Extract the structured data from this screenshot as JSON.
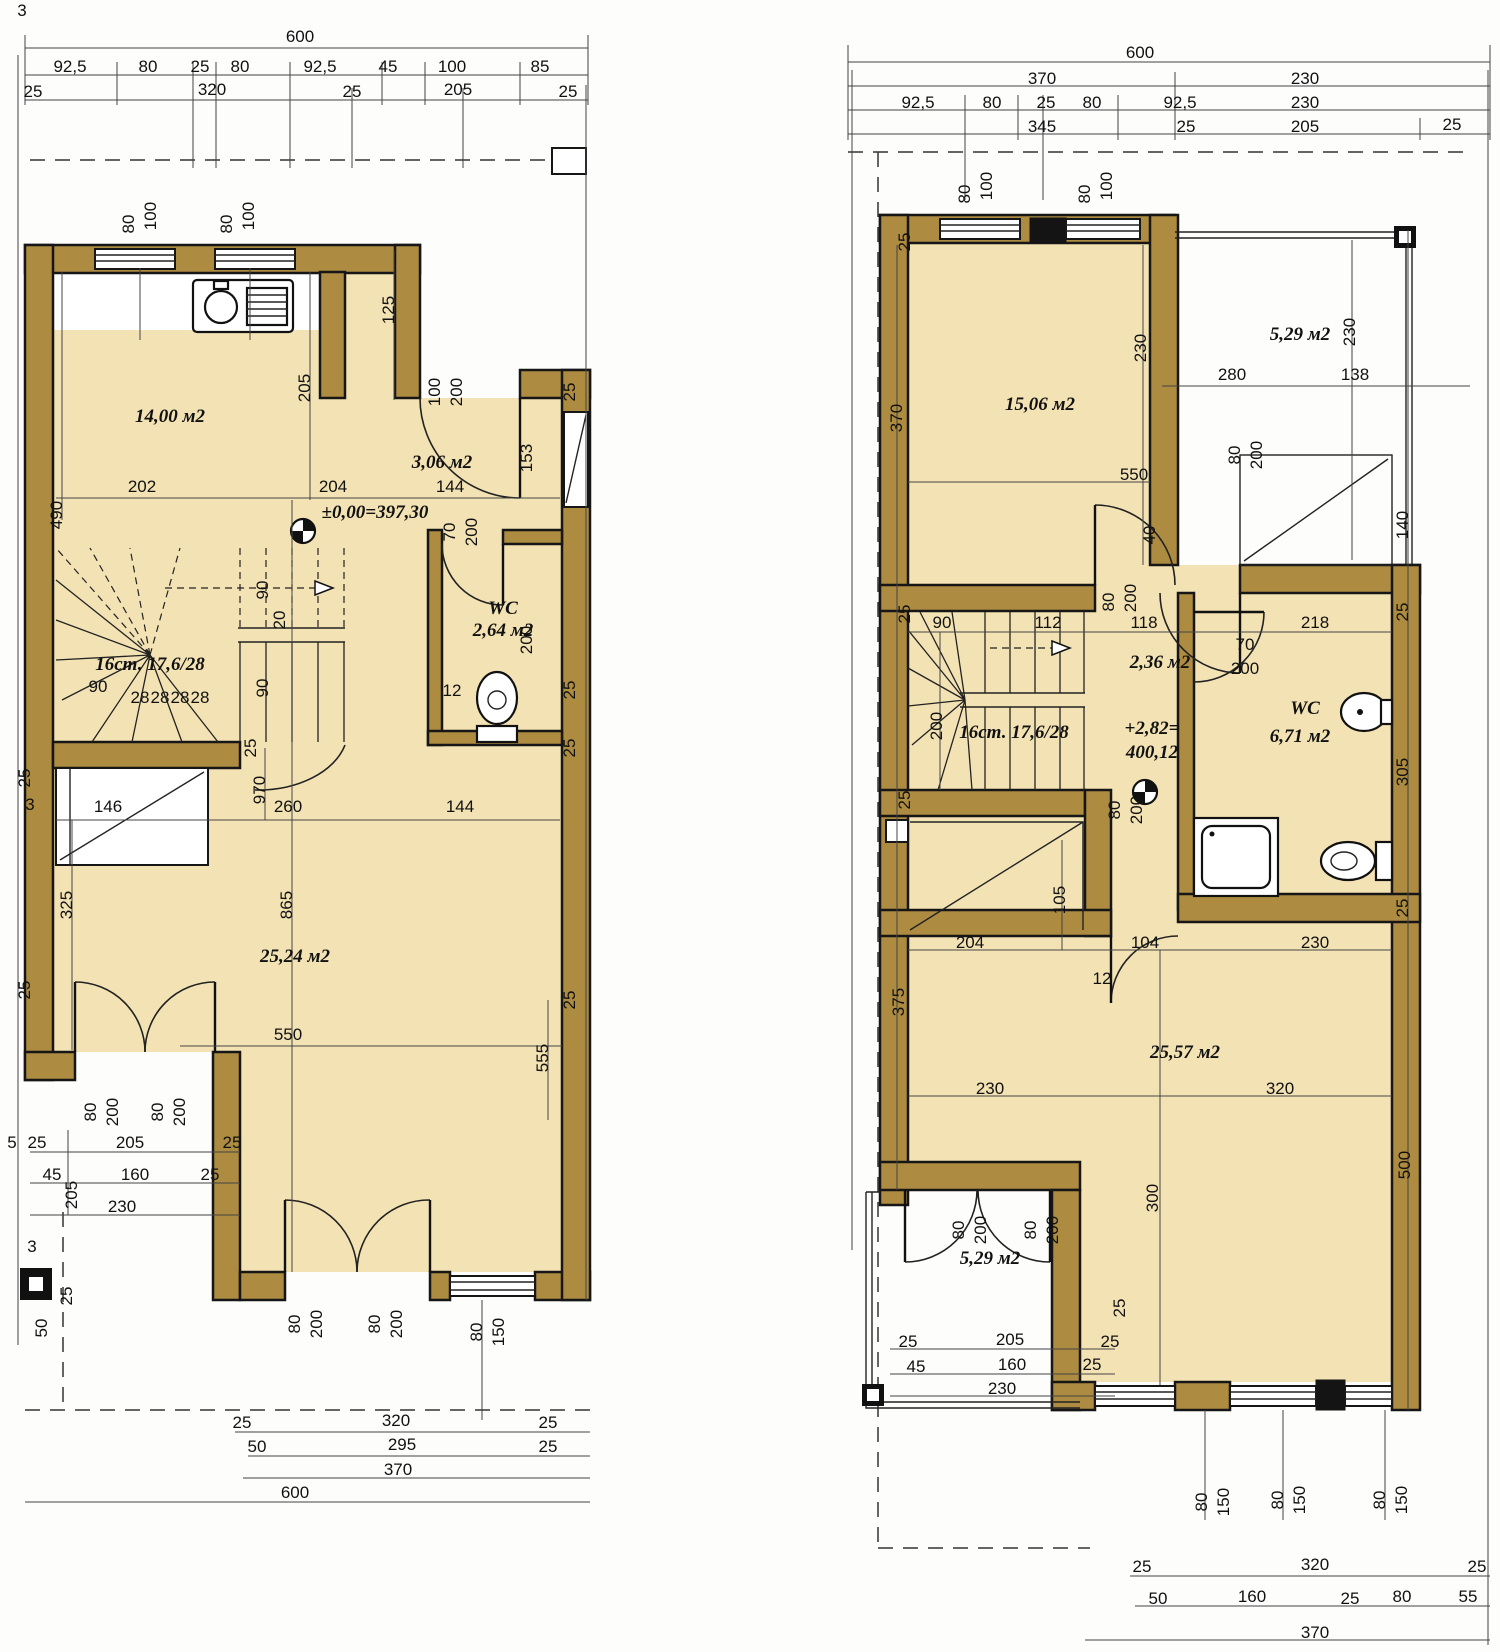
{
  "drawing": {
    "type": "architectural floor plans",
    "units": "cm",
    "plans": {
      "left": {
        "name": "ground floor plan",
        "overall_width": "600",
        "level_mark": "±0,00=397,30",
        "stairs": "16ст. 17,6/28",
        "rooms": [
          "14,00 м2",
          "3,06 м2",
          "WC 2,64 м2",
          "25,24 м2"
        ]
      },
      "right": {
        "name": "upper floor plan",
        "overall_width": "600",
        "level_mark": "+2,82= 400,12",
        "stairs": "16ст. 17,6/28",
        "rooms": [
          "15,06 м2",
          "5,29 м2",
          "2,36 м2",
          "WC 6,71 м2",
          "25,57 м2",
          "5,29 м2"
        ]
      }
    },
    "colors": {
      "wall": "#ad8c41",
      "floor": "#f3e3b4",
      "line": "#161616",
      "background": "#fdfdfc"
    }
  },
  "labels": [
    {
      "t": "3",
      "x": 22,
      "y": 16
    },
    {
      "t": "600",
      "x": 300,
      "y": 42
    },
    {
      "t": "92,5",
      "x": 70,
      "y": 72
    },
    {
      "t": "80",
      "x": 148,
      "y": 72
    },
    {
      "t": "25",
      "x": 200,
      "y": 72
    },
    {
      "t": "80",
      "x": 240,
      "y": 72
    },
    {
      "t": "92,5",
      "x": 320,
      "y": 72
    },
    {
      "t": "45",
      "x": 388,
      "y": 72
    },
    {
      "t": "100",
      "x": 452,
      "y": 72
    },
    {
      "t": "85",
      "x": 540,
      "y": 72
    },
    {
      "t": "25",
      "x": 33,
      "y": 97
    },
    {
      "t": "320",
      "x": 212,
      "y": 95
    },
    {
      "t": "25",
      "x": 352,
      "y": 97
    },
    {
      "t": "205",
      "x": 458,
      "y": 95
    },
    {
      "t": "25",
      "x": 568,
      "y": 97
    },
    {
      "t": "80",
      "x": 134,
      "y": 224,
      "r": -90
    },
    {
      "t": "100",
      "x": 156,
      "y": 216,
      "r": -90
    },
    {
      "t": "80",
      "x": 232,
      "y": 224,
      "r": -90
    },
    {
      "t": "100",
      "x": 254,
      "y": 216,
      "r": -90
    },
    {
      "t": "125",
      "x": 394,
      "y": 310,
      "r": -90
    },
    {
      "t": "205",
      "x": 310,
      "y": 388,
      "r": -90
    },
    {
      "t": "100",
      "x": 440,
      "y": 392,
      "r": -90
    },
    {
      "t": "200",
      "x": 462,
      "y": 392,
      "r": -90
    },
    {
      "t": "153",
      "x": 532,
      "y": 458,
      "r": -90
    },
    {
      "t": "14,00 м2",
      "x": 170,
      "y": 422,
      "cls": "r",
      "n": "room-label-kitchen"
    },
    {
      "t": "3,06 м2",
      "x": 442,
      "y": 468,
      "cls": "r",
      "n": "room-label-hall"
    },
    {
      "t": "202",
      "x": 142,
      "y": 492
    },
    {
      "t": "204",
      "x": 333,
      "y": 492
    },
    {
      "t": "144",
      "x": 450,
      "y": 492
    },
    {
      "t": "490",
      "x": 62,
      "y": 515,
      "r": -90
    },
    {
      "t": "±0,00=397,30",
      "x": 375,
      "y": 518,
      "cls": "r",
      "n": "level-mark-ground"
    },
    {
      "t": "70",
      "x": 455,
      "y": 532,
      "r": -90
    },
    {
      "t": "200",
      "x": 477,
      "y": 532,
      "r": -90
    },
    {
      "t": "WC",
      "x": 503,
      "y": 614,
      "cls": "r",
      "n": "room-label-wc"
    },
    {
      "t": "2,64 м2",
      "x": 503,
      "y": 636,
      "cls": "r"
    },
    {
      "t": "200",
      "x": 532,
      "y": 640,
      "r": -90
    },
    {
      "t": "90",
      "x": 268,
      "y": 590,
      "r": -90
    },
    {
      "t": "20",
      "x": 285,
      "y": 620,
      "r": -90
    },
    {
      "t": "90",
      "x": 268,
      "y": 688,
      "r": -90
    },
    {
      "t": "16ст. 17,6/28",
      "x": 150,
      "y": 670,
      "cls": "r",
      "n": "stairs-label"
    },
    {
      "t": "90",
      "x": 98,
      "y": 692
    },
    {
      "t": "28",
      "x": 140,
      "y": 703,
      "s": 14
    },
    {
      "t": "28",
      "x": 160,
      "y": 703,
      "s": 14
    },
    {
      "t": "28",
      "x": 180,
      "y": 703,
      "s": 14
    },
    {
      "t": "28",
      "x": 200,
      "y": 703,
      "s": 14
    },
    {
      "t": "12",
      "x": 452,
      "y": 696
    },
    {
      "t": "25",
      "x": 575,
      "y": 392,
      "r": -90
    },
    {
      "t": "25",
      "x": 575,
      "y": 690,
      "r": -90
    },
    {
      "t": "25",
      "x": 575,
      "y": 748,
      "r": -90
    },
    {
      "t": "25",
      "x": 256,
      "y": 748,
      "r": -90
    },
    {
      "t": "25",
      "x": 30,
      "y": 778,
      "r": -90
    },
    {
      "t": "3",
      "x": 30,
      "y": 810
    },
    {
      "t": "25",
      "x": 575,
      "y": 1000,
      "r": -90
    },
    {
      "t": "25",
      "x": 30,
      "y": 990,
      "r": -90
    },
    {
      "t": "146",
      "x": 108,
      "y": 812
    },
    {
      "t": "260",
      "x": 288,
      "y": 812
    },
    {
      "t": "144",
      "x": 460,
      "y": 812
    },
    {
      "t": "970",
      "x": 265,
      "y": 790,
      "r": -90
    },
    {
      "t": "865",
      "x": 292,
      "y": 905,
      "r": -90
    },
    {
      "t": "325",
      "x": 72,
      "y": 905,
      "r": -90
    },
    {
      "t": "25,24 м2",
      "x": 295,
      "y": 962,
      "cls": "r",
      "n": "room-label-living"
    },
    {
      "t": "550",
      "x": 288,
      "y": 1040
    },
    {
      "t": "555",
      "x": 548,
      "y": 1058,
      "r": -90
    },
    {
      "t": "80",
      "x": 96,
      "y": 1112,
      "r": -90
    },
    {
      "t": "200",
      "x": 118,
      "y": 1112,
      "r": -90
    },
    {
      "t": "80",
      "x": 163,
      "y": 1112,
      "r": -90
    },
    {
      "t": "200",
      "x": 185,
      "y": 1112,
      "r": -90
    },
    {
      "t": "5",
      "x": 12,
      "y": 1148,
      "s": 14
    },
    {
      "t": "25",
      "x": 37,
      "y": 1148
    },
    {
      "t": "205",
      "x": 130,
      "y": 1148
    },
    {
      "t": "25",
      "x": 232,
      "y": 1148
    },
    {
      "t": "45",
      "x": 52,
      "y": 1180
    },
    {
      "t": "160",
      "x": 135,
      "y": 1180
    },
    {
      "t": "25",
      "x": 210,
      "y": 1180
    },
    {
      "t": "205",
      "x": 77,
      "y": 1195,
      "r": -90
    },
    {
      "t": "230",
      "x": 122,
      "y": 1212
    },
    {
      "t": "3",
      "x": 32,
      "y": 1252
    },
    {
      "t": "25",
      "x": 72,
      "y": 1296,
      "r": -90
    },
    {
      "t": "50",
      "x": 47,
      "y": 1328,
      "r": -90
    },
    {
      "t": "80",
      "x": 300,
      "y": 1324,
      "r": -90
    },
    {
      "t": "200",
      "x": 322,
      "y": 1324,
      "r": -90
    },
    {
      "t": "80",
      "x": 380,
      "y": 1324,
      "r": -90
    },
    {
      "t": "200",
      "x": 402,
      "y": 1324,
      "r": -90
    },
    {
      "t": "80",
      "x": 482,
      "y": 1332,
      "r": -90
    },
    {
      "t": "150",
      "x": 504,
      "y": 1332,
      "r": -90
    },
    {
      "t": "25",
      "x": 242,
      "y": 1428
    },
    {
      "t": "320",
      "x": 396,
      "y": 1426
    },
    {
      "t": "25",
      "x": 548,
      "y": 1428
    },
    {
      "t": "50",
      "x": 257,
      "y": 1452
    },
    {
      "t": "295",
      "x": 402,
      "y": 1450
    },
    {
      "t": "25",
      "x": 548,
      "y": 1452
    },
    {
      "t": "370",
      "x": 398,
      "y": 1475
    },
    {
      "t": "600",
      "x": 295,
      "y": 1498
    },
    {
      "t": "600",
      "x": 1140,
      "y": 58
    },
    {
      "t": "370",
      "x": 1042,
      "y": 84
    },
    {
      "t": "230",
      "x": 1305,
      "y": 84
    },
    {
      "t": "92,5",
      "x": 918,
      "y": 108
    },
    {
      "t": "80",
      "x": 992,
      "y": 108
    },
    {
      "t": "25",
      "x": 1046,
      "y": 108
    },
    {
      "t": "80",
      "x": 1092,
      "y": 108
    },
    {
      "t": "92,5",
      "x": 1180,
      "y": 108
    },
    {
      "t": "230",
      "x": 1305,
      "y": 108
    },
    {
      "t": "345",
      "x": 1042,
      "y": 132
    },
    {
      "t": "25",
      "x": 1186,
      "y": 132
    },
    {
      "t": "205",
      "x": 1305,
      "y": 132
    },
    {
      "t": "25",
      "x": 1452,
      "y": 130
    },
    {
      "t": "80",
      "x": 970,
      "y": 194,
      "r": -90
    },
    {
      "t": "100",
      "x": 992,
      "y": 186,
      "r": -90
    },
    {
      "t": "80",
      "x": 1090,
      "y": 194,
      "r": -90
    },
    {
      "t": "100",
      "x": 1112,
      "y": 186,
      "r": -90
    },
    {
      "t": "25",
      "x": 910,
      "y": 242,
      "r": -90
    },
    {
      "t": "230",
      "x": 1146,
      "y": 348,
      "r": -90
    },
    {
      "t": "370",
      "x": 902,
      "y": 418,
      "r": -90
    },
    {
      "t": "15,06 м2",
      "x": 1040,
      "y": 410,
      "cls": "r",
      "n": "room-label-bedroom"
    },
    {
      "t": "5,29 м2",
      "x": 1300,
      "y": 340,
      "cls": "r",
      "n": "room-label-terrace"
    },
    {
      "t": "230",
      "x": 1355,
      "y": 332,
      "r": -90
    },
    {
      "t": "280",
      "x": 1232,
      "y": 380
    },
    {
      "t": "138",
      "x": 1355,
      "y": 380
    },
    {
      "t": "80",
      "x": 1240,
      "y": 455,
      "r": -90
    },
    {
      "t": "200",
      "x": 1262,
      "y": 455,
      "r": -90
    },
    {
      "t": "550",
      "x": 1134,
      "y": 480
    },
    {
      "t": "40",
      "x": 1155,
      "y": 535,
      "r": -90
    },
    {
      "t": "140",
      "x": 1408,
      "y": 525,
      "r": -90
    },
    {
      "t": "25",
      "x": 910,
      "y": 614,
      "r": -90
    },
    {
      "t": "90",
      "x": 942,
      "y": 628
    },
    {
      "t": "112",
      "x": 1048,
      "y": 628
    },
    {
      "t": "118",
      "x": 1144,
      "y": 628
    },
    {
      "t": "70",
      "x": 1245,
      "y": 650
    },
    {
      "t": "200",
      "x": 1245,
      "y": 674
    },
    {
      "t": "218",
      "x": 1315,
      "y": 628
    },
    {
      "t": "2,36 м2",
      "x": 1160,
      "y": 668,
      "cls": "r",
      "n": "room-label-hall2"
    },
    {
      "t": "80",
      "x": 1114,
      "y": 602,
      "r": -90
    },
    {
      "t": "200",
      "x": 1136,
      "y": 598,
      "r": -90
    },
    {
      "t": "200",
      "x": 942,
      "y": 726,
      "r": -90
    },
    {
      "t": "16ст. 17,6/28",
      "x": 1014,
      "y": 738,
      "cls": "r",
      "n": "stairs-label-2"
    },
    {
      "t": "+2,82=",
      "x": 1152,
      "y": 734,
      "cls": "r",
      "n": "level-mark-upper"
    },
    {
      "t": "400,12",
      "x": 1152,
      "y": 758,
      "cls": "r"
    },
    {
      "t": "WC",
      "x": 1305,
      "y": 714,
      "cls": "r",
      "n": "room-label-wc2"
    },
    {
      "t": "6,71 м2",
      "x": 1300,
      "y": 742,
      "cls": "r"
    },
    {
      "t": "305",
      "x": 1408,
      "y": 772,
      "r": -90
    },
    {
      "t": "25",
      "x": 1408,
      "y": 612,
      "r": -90
    },
    {
      "t": "25",
      "x": 1408,
      "y": 908,
      "r": -90
    },
    {
      "t": "25",
      "x": 910,
      "y": 800,
      "r": -90
    },
    {
      "t": "80",
      "x": 1120,
      "y": 810,
      "r": -90
    },
    {
      "t": "200",
      "x": 1142,
      "y": 810,
      "r": -90
    },
    {
      "t": "105",
      "x": 1065,
      "y": 900,
      "r": -90
    },
    {
      "t": "204",
      "x": 970,
      "y": 948
    },
    {
      "t": "104",
      "x": 1145,
      "y": 948
    },
    {
      "t": "230",
      "x": 1315,
      "y": 948
    },
    {
      "t": "12",
      "x": 1102,
      "y": 984
    },
    {
      "t": "375",
      "x": 904,
      "y": 1002,
      "r": -90
    },
    {
      "t": "25,57 м2",
      "x": 1185,
      "y": 1058,
      "cls": "r",
      "n": "room-label-living2"
    },
    {
      "t": "230",
      "x": 990,
      "y": 1094
    },
    {
      "t": "320",
      "x": 1280,
      "y": 1094
    },
    {
      "t": "300",
      "x": 1158,
      "y": 1198,
      "r": -90
    },
    {
      "t": "500",
      "x": 1410,
      "y": 1165,
      "r": -90
    },
    {
      "t": "80",
      "x": 964,
      "y": 1230,
      "r": -90
    },
    {
      "t": "200",
      "x": 986,
      "y": 1230,
      "r": -90
    },
    {
      "t": "80",
      "x": 1036,
      "y": 1230,
      "r": -90
    },
    {
      "t": "200",
      "x": 1058,
      "y": 1230,
      "r": -90
    },
    {
      "t": "5,29 м2",
      "x": 990,
      "y": 1264,
      "cls": "r",
      "n": "room-label-balcony"
    },
    {
      "t": "25",
      "x": 908,
      "y": 1347
    },
    {
      "t": "205",
      "x": 1010,
      "y": 1345
    },
    {
      "t": "25",
      "x": 1110,
      "y": 1347
    },
    {
      "t": "45",
      "x": 916,
      "y": 1372
    },
    {
      "t": "160",
      "x": 1012,
      "y": 1370
    },
    {
      "t": "25",
      "x": 1092,
      "y": 1370
    },
    {
      "t": "230",
      "x": 1002,
      "y": 1394
    },
    {
      "t": "25",
      "x": 1125,
      "y": 1308,
      "r": -90
    },
    {
      "t": "80",
      "x": 1207,
      "y": 1502,
      "r": -90
    },
    {
      "t": "150",
      "x": 1229,
      "y": 1502,
      "r": -90
    },
    {
      "t": "80",
      "x": 1283,
      "y": 1500,
      "r": -90
    },
    {
      "t": "150",
      "x": 1305,
      "y": 1500,
      "r": -90
    },
    {
      "t": "80",
      "x": 1385,
      "y": 1500,
      "r": -90
    },
    {
      "t": "150",
      "x": 1407,
      "y": 1500,
      "r": -90
    },
    {
      "t": "25",
      "x": 1142,
      "y": 1572
    },
    {
      "t": "320",
      "x": 1315,
      "y": 1570
    },
    {
      "t": "25",
      "x": 1477,
      "y": 1572
    },
    {
      "t": "50",
      "x": 1158,
      "y": 1604
    },
    {
      "t": "160",
      "x": 1252,
      "y": 1602
    },
    {
      "t": "25",
      "x": 1350,
      "y": 1604
    },
    {
      "t": "80",
      "x": 1402,
      "y": 1602
    },
    {
      "t": "55",
      "x": 1468,
      "y": 1602
    },
    {
      "t": "370",
      "x": 1315,
      "y": 1638
    }
  ]
}
